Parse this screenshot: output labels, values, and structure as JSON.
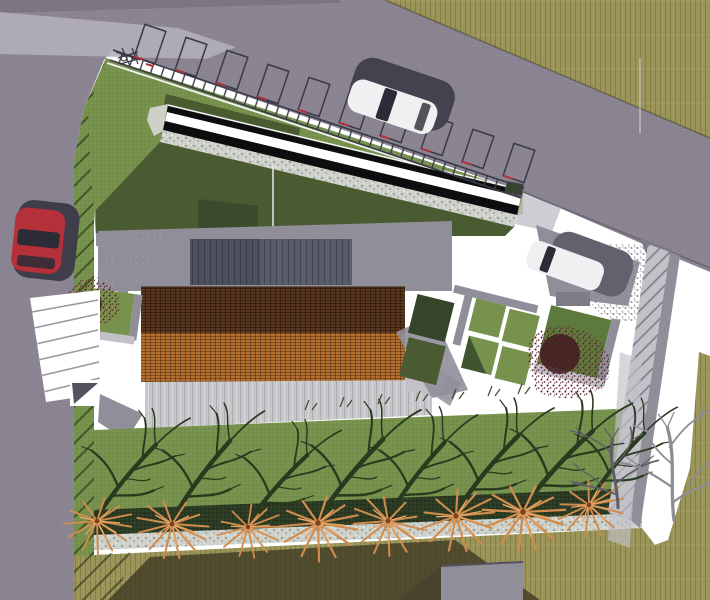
{
  "scene": {
    "description": "Aerial top-down 3D architectural site plan rendering",
    "view": "plan view, winter scene",
    "objects": {
      "building": "house with two-tone clay tile gable roof, dark panel upper roof and pale plank terrace",
      "canopy": "long black canopy with white skylight strip and gravel edging",
      "parking_bays": 10,
      "railing": "roadside guard railing with rungs",
      "bike_rack": "bicycle rack at west end of railing",
      "cars": [
        "red car on west road",
        "white car parked on north road",
        "white car in east court"
      ],
      "garden_plots": 7,
      "red_shrubs": 2,
      "row_trees": 8,
      "solitary_tree": "bare winter tree at east edge",
      "stairs": "stepped ramp from west road",
      "shed": "small flat-roof structure at south edge",
      "ground": [
        "asphalt roads",
        "white paved court",
        "lawn slope with hatching",
        "hedge strip",
        "gravel strip",
        "rough grass field",
        "hatched retaining wall"
      ]
    }
  },
  "colors": {
    "court": "#ffffff",
    "road": "#8a8492",
    "road_light": "#b3aebb",
    "road_dark": "#7b7682",
    "field": "#9b9559",
    "field_shadow": "#3c3722",
    "lawn": "#76924d",
    "lawn_shadow": "#4a5a31",
    "lawn_dark": "#35452a",
    "hedge": "#2b3a23",
    "gravel": "#cdd1ca",
    "pergola": "#0d0d10",
    "stripe": "#ffffff",
    "roof_dark": "#59361d",
    "roof_light": "#b46f2e",
    "panel": "#585c6a",
    "plank": "#c7c7cb",
    "wall_gray": "#908e99",
    "wall_light": "#c2c1c8",
    "car_red": "#b6303a",
    "car_white": "#eef0f2",
    "car_shadow": "#3e3d49",
    "glass": "#2c2c36",
    "shrub_core": "#421a20",
    "branch_dark": "#2a3a1e",
    "branch_orange": "#d08c4e",
    "branch_gray": "#8d8d95",
    "branch_shadow": "#5d5d66",
    "rail": "#3a3a46",
    "red_accent": "#b23038",
    "white_line": "#f3f3f5"
  }
}
